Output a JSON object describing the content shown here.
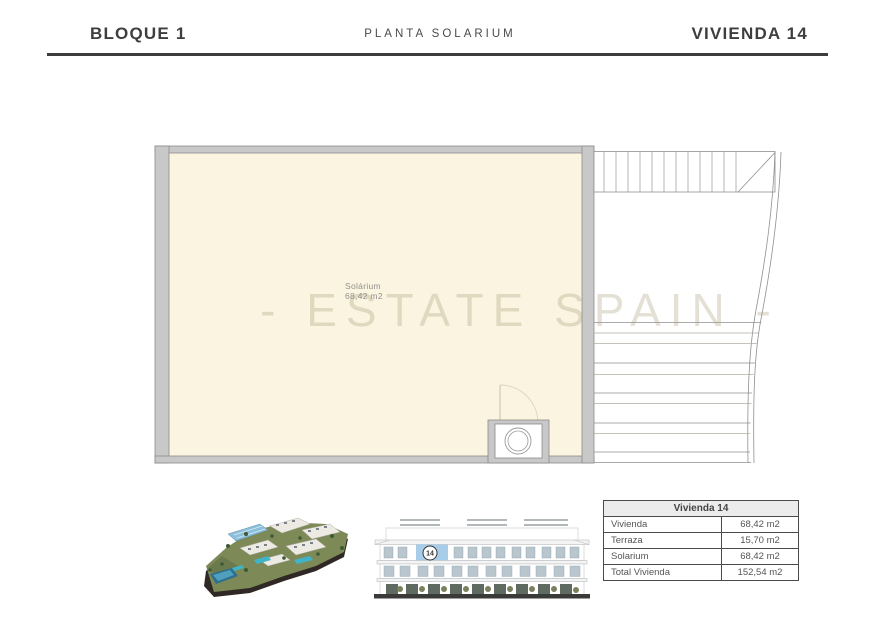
{
  "header": {
    "left": "BLOQUE 1",
    "center": "PLANTA SOLARIUM",
    "right": "VIVIENDA 14"
  },
  "plan": {
    "room_label": "Solárium",
    "room_area": "68,42 m2",
    "watermark": "- ESTATE SPAIN -"
  },
  "summary_table": {
    "title": "Vivienda 14",
    "rows": [
      {
        "label": "Vivienda",
        "value": "68,42 m2"
      },
      {
        "label": "Terraza",
        "value": "15,70 m2"
      },
      {
        "label": "Solarium",
        "value": "68,42 m2"
      },
      {
        "label": "Total Vivienda",
        "value": "152,54 m2"
      }
    ]
  },
  "elevation": {
    "unit_badge": "14"
  },
  "colors": {
    "wall_fill": "#c8c8c8",
    "wall_stroke": "#8b8b8b",
    "room_fill": "#fbf4e0",
    "rule": "#3c3c3c",
    "watermark": "#a89b78",
    "table_border": "#4a4a4a",
    "table_header_bg": "#ececec",
    "highlight_unit": "#a8cde8"
  }
}
